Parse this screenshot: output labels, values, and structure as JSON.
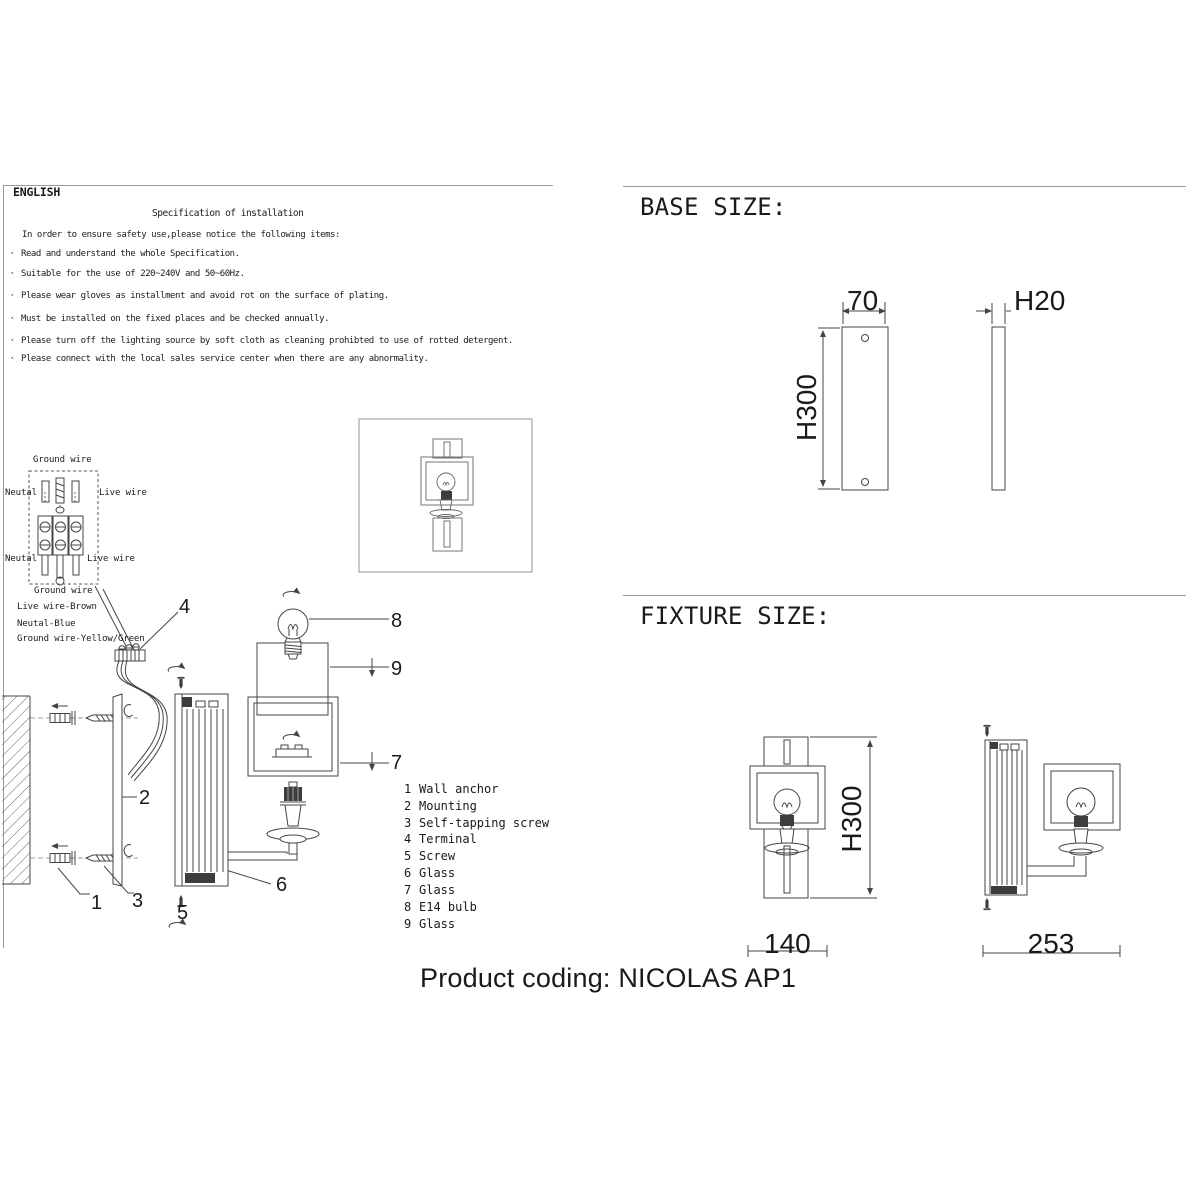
{
  "instructions": {
    "language": "ENGLISH",
    "title": "Specification of installation",
    "intro": "In order to ensure safety use,please notice the following items:",
    "bullet_char": "·",
    "items": [
      "Read and understand the whole Specification.",
      "Suitable for the use of 220~240V and 50~60Hz.",
      "Please wear gloves as installment and avoid rot on the surface of plating.",
      "Must be installed on the fixed places and be checked annually.",
      "Please turn off the lighting source by soft cloth as cleaning prohibted to use of rotted detergent.",
      "Please connect with the local sales service center when there are any abnormality."
    ]
  },
  "wiring": {
    "ground_wire_top": "Ground wire",
    "neutral_top": "Neutal",
    "live_top": "Live wire",
    "neutral_bottom": "Neutal",
    "live_bottom": "Live wire",
    "ground_wire_bottom": "Ground wire",
    "legend": [
      "Live wire-Brown",
      "Neutal-Blue",
      "Ground wire-Yellow/Green"
    ]
  },
  "parts": [
    {
      "num": "1",
      "name": "Wall anchor"
    },
    {
      "num": "2",
      "name": "Mounting"
    },
    {
      "num": "3",
      "name": "Self-tapping screw"
    },
    {
      "num": "4",
      "name": "Terminal"
    },
    {
      "num": "5",
      "name": "Screw"
    },
    {
      "num": "6",
      "name": "Glass"
    },
    {
      "num": "7",
      "name": "Glass"
    },
    {
      "num": "8",
      "name": "E14 bulb"
    },
    {
      "num": "9",
      "name": "Glass"
    }
  ],
  "base_size": {
    "title": "BASE SIZE:",
    "width_label": "70",
    "height_label": "H300",
    "depth_label": "H20"
  },
  "fixture_size": {
    "title": "FIXTURE SIZE:",
    "height_label": "H300",
    "width_label": "140",
    "depth_label": "253"
  },
  "footer": {
    "product_coding": "Product coding: NICOLAS AP1"
  }
}
